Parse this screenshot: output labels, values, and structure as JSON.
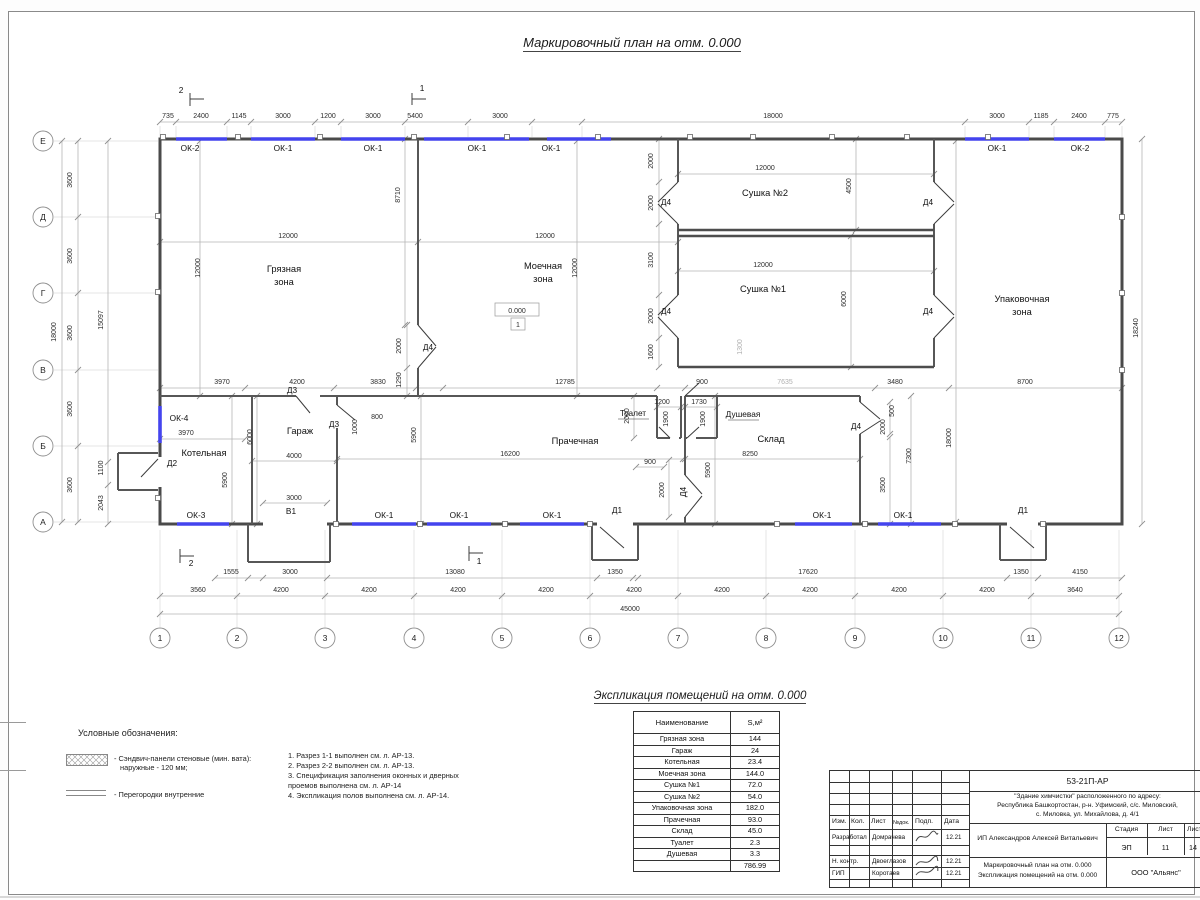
{
  "titles": {
    "main": "Маркировочный план на отм. 0.000",
    "table": "Экспликация помещений на отм. 0.000"
  },
  "plan": {
    "elevation": "0.000",
    "floor_mark": "1",
    "axes_bottom": [
      {
        "t": "1",
        "x": 160
      },
      {
        "t": "2",
        "x": 237
      },
      {
        "t": "3",
        "x": 325
      },
      {
        "t": "4",
        "x": 414
      },
      {
        "t": "5",
        "x": 502
      },
      {
        "t": "6",
        "x": 590
      },
      {
        "t": "7",
        "x": 678
      },
      {
        "t": "8",
        "x": 766
      },
      {
        "t": "9",
        "x": 855
      },
      {
        "t": "10",
        "x": 943
      },
      {
        "t": "11",
        "x": 1031
      },
      {
        "t": "12",
        "x": 1119
      }
    ],
    "axes_left": [
      {
        "t": "Е",
        "y": 141
      },
      {
        "t": "Д",
        "y": 217
      },
      {
        "t": "Г",
        "y": 293
      },
      {
        "t": "В",
        "y": 370
      },
      {
        "t": "Б",
        "y": 446
      },
      {
        "t": "А",
        "y": 522
      }
    ],
    "labels": [
      {
        "t": "735",
        "x": 168,
        "y": 118,
        "k": "d"
      },
      {
        "t": "2400",
        "x": 201,
        "y": 118,
        "k": "d"
      },
      {
        "t": "1145",
        "x": 239,
        "y": 118,
        "k": "d"
      },
      {
        "t": "3000",
        "x": 283,
        "y": 118,
        "k": "d"
      },
      {
        "t": "1200",
        "x": 328,
        "y": 118,
        "k": "d"
      },
      {
        "t": "3000",
        "x": 373,
        "y": 118,
        "k": "d"
      },
      {
        "t": "5400",
        "x": 415,
        "y": 118,
        "k": "d"
      },
      {
        "t": "3000",
        "x": 500,
        "y": 118,
        "k": "d"
      },
      {
        "t": "18000",
        "x": 773,
        "y": 118,
        "k": "d"
      },
      {
        "t": "3000",
        "x": 997,
        "y": 118,
        "k": "d"
      },
      {
        "t": "1185",
        "x": 1041,
        "y": 118,
        "k": "d"
      },
      {
        "t": "2400",
        "x": 1079,
        "y": 118,
        "k": "d"
      },
      {
        "t": "775",
        "x": 1113,
        "y": 118,
        "k": "d"
      },
      {
        "t": "ОК-2",
        "x": 190,
        "y": 151,
        "k": "m"
      },
      {
        "t": "ОК-1",
        "x": 283,
        "y": 151,
        "k": "m"
      },
      {
        "t": "ОК-1",
        "x": 373,
        "y": 151,
        "k": "m"
      },
      {
        "t": "ОК-1",
        "x": 477,
        "y": 151,
        "k": "m"
      },
      {
        "t": "ОК-1",
        "x": 551,
        "y": 151,
        "k": "m"
      },
      {
        "t": "ОК-1",
        "x": 997,
        "y": 151,
        "k": "m"
      },
      {
        "t": "ОК-2",
        "x": 1080,
        "y": 151,
        "k": "m"
      },
      {
        "t": "ОК-4",
        "x": 179,
        "y": 421,
        "k": "m"
      },
      {
        "t": "ОК-3",
        "x": 196,
        "y": 518,
        "k": "m"
      },
      {
        "t": "ОК-1",
        "x": 384,
        "y": 518,
        "k": "m"
      },
      {
        "t": "ОК-1",
        "x": 459,
        "y": 518,
        "k": "m"
      },
      {
        "t": "ОК-1",
        "x": 552,
        "y": 518,
        "k": "m"
      },
      {
        "t": "ОК-1",
        "x": 822,
        "y": 518,
        "k": "m"
      },
      {
        "t": "ОК-1",
        "x": 903,
        "y": 518,
        "k": "m"
      },
      {
        "t": "Д1",
        "x": 617,
        "y": 513,
        "k": "m"
      },
      {
        "t": "Д1",
        "x": 1023,
        "y": 513,
        "k": "m"
      },
      {
        "t": "Д2",
        "x": 172,
        "y": 466,
        "k": "m"
      },
      {
        "t": "Д3",
        "x": 292,
        "y": 393,
        "k": "m"
      },
      {
        "t": "Д3",
        "x": 334,
        "y": 427,
        "k": "m"
      },
      {
        "t": "Д4",
        "x": 428,
        "y": 350,
        "k": "m"
      },
      {
        "t": "Д4",
        "x": 666,
        "y": 205,
        "k": "m"
      },
      {
        "t": "Д4",
        "x": 928,
        "y": 205,
        "k": "m"
      },
      {
        "t": "Д4",
        "x": 666,
        "y": 314,
        "k": "m"
      },
      {
        "t": "Д4",
        "x": 928,
        "y": 314,
        "k": "m"
      },
      {
        "t": "Д4",
        "x": 856,
        "y": 429,
        "k": "m"
      },
      {
        "t": "Д4",
        "x": 686,
        "y": 492,
        "k": "m",
        "r": 1
      },
      {
        "t": "В1",
        "x": 291,
        "y": 514,
        "k": "m"
      },
      {
        "t": "2",
        "x": 181,
        "y": 93,
        "k": "m"
      },
      {
        "t": "1",
        "x": 422,
        "y": 91,
        "k": "m"
      },
      {
        "t": "2",
        "x": 191,
        "y": 566,
        "k": "m"
      },
      {
        "t": "1",
        "x": 479,
        "y": 564,
        "k": "m"
      },
      {
        "t": "Грязная",
        "x": 284,
        "y": 272,
        "k": "r"
      },
      {
        "t": "зона",
        "x": 284,
        "y": 285,
        "k": "r"
      },
      {
        "t": "Моечная",
        "x": 543,
        "y": 269,
        "k": "r"
      },
      {
        "t": "зона",
        "x": 543,
        "y": 282,
        "k": "r"
      },
      {
        "t": "Сушка №2",
        "x": 765,
        "y": 196,
        "k": "r"
      },
      {
        "t": "Сушка №1",
        "x": 763,
        "y": 292,
        "k": "r"
      },
      {
        "t": "Упаковочная",
        "x": 1022,
        "y": 302,
        "k": "r"
      },
      {
        "t": "зона",
        "x": 1022,
        "y": 315,
        "k": "r"
      },
      {
        "t": "Котельная",
        "x": 204,
        "y": 456,
        "k": "r"
      },
      {
        "t": "Гараж",
        "x": 300,
        "y": 434,
        "k": "r"
      },
      {
        "t": "Прачечная",
        "x": 575,
        "y": 444,
        "k": "r"
      },
      {
        "t": "Склад",
        "x": 771,
        "y": 442,
        "k": "r"
      },
      {
        "t": "Туалет",
        "x": 633,
        "y": 416,
        "k": "m"
      },
      {
        "t": "Душевая",
        "x": 743,
        "y": 417,
        "k": "m"
      },
      {
        "t": "3600",
        "x": 72,
        "y": 180,
        "k": "d",
        "r": 1
      },
      {
        "t": "3600",
        "x": 72,
        "y": 256,
        "k": "d",
        "r": 1
      },
      {
        "t": "3600",
        "x": 72,
        "y": 333,
        "k": "d",
        "r": 1
      },
      {
        "t": "3600",
        "x": 72,
        "y": 409,
        "k": "d",
        "r": 1
      },
      {
        "t": "3600",
        "x": 72,
        "y": 485,
        "k": "d",
        "r": 1
      },
      {
        "t": "18000",
        "x": 56,
        "y": 332,
        "k": "d",
        "r": 1
      },
      {
        "t": "15097",
        "x": 103,
        "y": 320,
        "k": "d",
        "r": 1
      },
      {
        "t": "1100",
        "x": 103,
        "y": 468,
        "k": "d",
        "r": 1
      },
      {
        "t": "2043",
        "x": 103,
        "y": 503,
        "k": "d",
        "r": 1
      },
      {
        "t": "18000",
        "x": 951,
        "y": 438,
        "k": "d",
        "r": 1
      },
      {
        "t": "18240",
        "x": 1138,
        "y": 328,
        "k": "d",
        "r": 1
      },
      {
        "t": "12000",
        "x": 288,
        "y": 238,
        "k": "d"
      },
      {
        "t": "12000",
        "x": 545,
        "y": 238,
        "k": "d"
      },
      {
        "t": "12000",
        "x": 200,
        "y": 268,
        "k": "d",
        "r": 1
      },
      {
        "t": "12000",
        "x": 577,
        "y": 268,
        "k": "d",
        "r": 1
      },
      {
        "t": "8710",
        "x": 400,
        "y": 195,
        "k": "d",
        "r": 1
      },
      {
        "t": "2000",
        "x": 401,
        "y": 346,
        "k": "d",
        "r": 1
      },
      {
        "t": "1290",
        "x": 401,
        "y": 380,
        "k": "d",
        "r": 1
      },
      {
        "t": "12000",
        "x": 765,
        "y": 170,
        "k": "d"
      },
      {
        "t": "12000",
        "x": 763,
        "y": 267,
        "k": "d"
      },
      {
        "t": "4500",
        "x": 851,
        "y": 186,
        "k": "d",
        "r": 1
      },
      {
        "t": "6000",
        "x": 846,
        "y": 299,
        "k": "d",
        "r": 1
      },
      {
        "t": "2000",
        "x": 653,
        "y": 161,
        "k": "d",
        "r": 1
      },
      {
        "t": "2000",
        "x": 653,
        "y": 203,
        "k": "d",
        "r": 1
      },
      {
        "t": "3100",
        "x": 653,
        "y": 260,
        "k": "d",
        "r": 1
      },
      {
        "t": "2000",
        "x": 653,
        "y": 316,
        "k": "d",
        "r": 1
      },
      {
        "t": "1600",
        "x": 653,
        "y": 352,
        "k": "d",
        "r": 1
      },
      {
        "t": "1300",
        "x": 742,
        "y": 347,
        "k": "d",
        "r": 1,
        "c": "g"
      },
      {
        "t": "3970",
        "x": 222,
        "y": 384,
        "k": "d"
      },
      {
        "t": "4200",
        "x": 297,
        "y": 384,
        "k": "d"
      },
      {
        "t": "3830",
        "x": 378,
        "y": 384,
        "k": "d"
      },
      {
        "t": "12785",
        "x": 565,
        "y": 384,
        "k": "d"
      },
      {
        "t": "900",
        "x": 702,
        "y": 384,
        "k": "d"
      },
      {
        "t": "7635",
        "x": 785,
        "y": 384,
        "k": "d",
        "c": "g"
      },
      {
        "t": "3480",
        "x": 895,
        "y": 384,
        "k": "d"
      },
      {
        "t": "8700",
        "x": 1025,
        "y": 384,
        "k": "d"
      },
      {
        "t": "3970",
        "x": 186,
        "y": 435,
        "k": "d"
      },
      {
        "t": "5900",
        "x": 227,
        "y": 480,
        "k": "d",
        "r": 1
      },
      {
        "t": "4000",
        "x": 294,
        "y": 458,
        "k": "d"
      },
      {
        "t": "6000",
        "x": 252,
        "y": 437,
        "k": "d",
        "r": 1
      },
      {
        "t": "1000",
        "x": 357,
        "y": 427,
        "k": "d",
        "r": 1
      },
      {
        "t": "800",
        "x": 377,
        "y": 419,
        "k": "d"
      },
      {
        "t": "3000",
        "x": 294,
        "y": 500,
        "k": "d"
      },
      {
        "t": "16200",
        "x": 510,
        "y": 456,
        "k": "d"
      },
      {
        "t": "5900",
        "x": 416,
        "y": 435,
        "k": "d",
        "r": 1
      },
      {
        "t": "2000",
        "x": 629,
        "y": 416,
        "k": "d",
        "r": 1
      },
      {
        "t": "1200",
        "x": 662,
        "y": 404,
        "k": "d"
      },
      {
        "t": "1730",
        "x": 699,
        "y": 404,
        "k": "d"
      },
      {
        "t": "1900",
        "x": 668,
        "y": 419,
        "k": "d",
        "r": 1
      },
      {
        "t": "1900",
        "x": 705,
        "y": 419,
        "k": "d",
        "r": 1
      },
      {
        "t": "900",
        "x": 650,
        "y": 464,
        "k": "d"
      },
      {
        "t": "2000",
        "x": 664,
        "y": 490,
        "k": "d",
        "r": 1
      },
      {
        "t": "8250",
        "x": 750,
        "y": 456,
        "k": "d"
      },
      {
        "t": "5900",
        "x": 710,
        "y": 470,
        "k": "d",
        "r": 1
      },
      {
        "t": "500",
        "x": 894,
        "y": 411,
        "k": "d",
        "r": 1
      },
      {
        "t": "2000",
        "x": 885,
        "y": 427,
        "k": "d",
        "r": 1
      },
      {
        "t": "7300",
        "x": 911,
        "y": 456,
        "k": "d",
        "r": 1
      },
      {
        "t": "3500",
        "x": 885,
        "y": 485,
        "k": "d",
        "r": 1
      },
      {
        "t": "1555",
        "x": 231,
        "y": 574,
        "k": "d"
      },
      {
        "t": "3000",
        "x": 290,
        "y": 574,
        "k": "d"
      },
      {
        "t": "13080",
        "x": 455,
        "y": 574,
        "k": "d"
      },
      {
        "t": "1350",
        "x": 615,
        "y": 574,
        "k": "d"
      },
      {
        "t": "17620",
        "x": 808,
        "y": 574,
        "k": "d"
      },
      {
        "t": "1350",
        "x": 1021,
        "y": 574,
        "k": "d"
      },
      {
        "t": "4150",
        "x": 1080,
        "y": 574,
        "k": "d"
      },
      {
        "t": "3560",
        "x": 198,
        "y": 592,
        "k": "d"
      },
      {
        "t": "4200",
        "x": 281,
        "y": 592,
        "k": "d"
      },
      {
        "t": "4200",
        "x": 369,
        "y": 592,
        "k": "d"
      },
      {
        "t": "4200",
        "x": 458,
        "y": 592,
        "k": "d"
      },
      {
        "t": "4200",
        "x": 546,
        "y": 592,
        "k": "d"
      },
      {
        "t": "4200",
        "x": 634,
        "y": 592,
        "k": "d"
      },
      {
        "t": "4200",
        "x": 722,
        "y": 592,
        "k": "d"
      },
      {
        "t": "4200",
        "x": 810,
        "y": 592,
        "k": "d"
      },
      {
        "t": "4200",
        "x": 899,
        "y": 592,
        "k": "d"
      },
      {
        "t": "4200",
        "x": 987,
        "y": 592,
        "k": "d"
      },
      {
        "t": "3640",
        "x": 1075,
        "y": 592,
        "k": "d"
      },
      {
        "t": "45000",
        "x": 630,
        "y": 611,
        "k": "d"
      },
      {
        "t": "0.000",
        "x": 517,
        "y": 313,
        "k": "d"
      },
      {
        "t": "1",
        "x": 518,
        "y": 327,
        "k": "d"
      }
    ]
  },
  "table": {
    "headers": [
      "Наименование",
      "S,м²"
    ],
    "rows": [
      [
        "Грязная зона",
        "144"
      ],
      [
        "Гараж",
        "24"
      ],
      [
        "Котельная",
        "23.4"
      ],
      [
        "Моечная зона",
        "144.0"
      ],
      [
        "Сушка №1",
        "72.0"
      ],
      [
        "Сушка №2",
        "54.0"
      ],
      [
        "Упаковочная зона",
        "182.0"
      ],
      [
        "Прачечная",
        "93.0"
      ],
      [
        "Склад",
        "45.0"
      ],
      [
        "Туалет",
        "2.3"
      ],
      [
        "Душевая",
        "3.3"
      ]
    ],
    "total": "786.99"
  },
  "legend": {
    "title": "Условные обозначения:",
    "item1_line1": "- Сэндвич-панели стеновые (мин. вата):",
    "item1_line2": "наружные - 120 мм;",
    "item2": "- Перегородки внутренние"
  },
  "notes": [
    "1. Разрез 1-1 выполнен см. л. АР-13.",
    "2. Разрез 2-2 выполнен см. л. АР-13.",
    "3. Спецификация заполнения оконных и дверных",
    "проемов выполнена см. л. АР-14",
    "4. Экспликация полов выполнена см. л. АР-14."
  ],
  "titleblock": {
    "code": "53-21П-АР",
    "addr1": "\"Здание химчистки\" расположенного по адресу:",
    "addr2": "Республика Башкортостан, р-н. Уфимский, с/с. Миловский,",
    "addr3": "с. Миловка, ул. Михайлова, д. 4/1",
    "col_izm": "Изм.",
    "col_kol": "Кол.",
    "col_list": "Лист",
    "col_ndok": "№док.",
    "col_podp": "Подп.",
    "col_data": "Дата",
    "r1_role": "Разработал",
    "r1_name": "Домрачева",
    "r1_date": "12.21",
    "client": "ИП Александров Алексей Витальевич",
    "stage_h1": "Стадия",
    "stage_h2": "Лист",
    "stage_h3": "Лист",
    "stage_v1": "ЭП",
    "stage_v2": "11",
    "stage_v3": "14",
    "r2_role": "Н. контр.",
    "r2_name": "Двоеглазов",
    "r2_date": "12.21",
    "r3_role": "ГИП",
    "r3_name": "Коротаев",
    "r3_date": "12.21",
    "doc1": "Маркировочный план на отм. 0.000",
    "doc2": "Экспликация помещений на отм. 0.000",
    "org": "ООО \"Альянс\""
  }
}
